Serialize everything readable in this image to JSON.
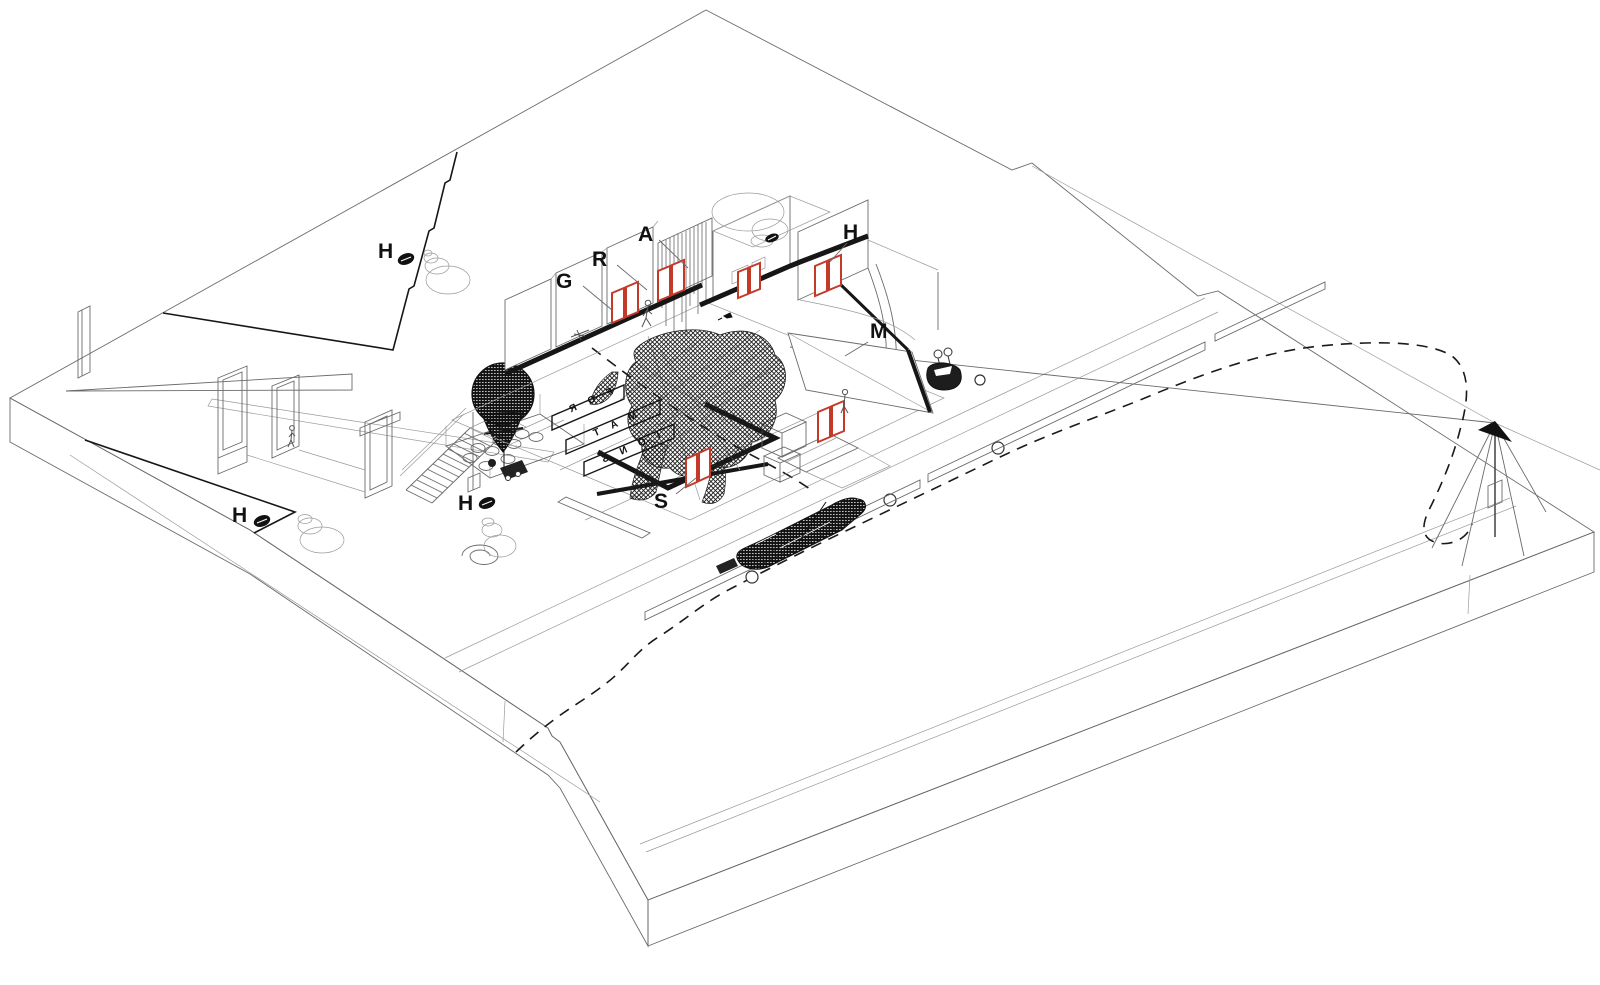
{
  "drawing": {
    "type": "axonometric-site-plan",
    "labels": [
      {
        "id": "G",
        "text": "G"
      },
      {
        "id": "R",
        "text": "R"
      },
      {
        "id": "A",
        "text": "A"
      },
      {
        "id": "H-wall",
        "text": "H"
      },
      {
        "id": "M",
        "text": "M"
      },
      {
        "id": "S",
        "text": "S"
      },
      {
        "id": "H-field",
        "text": "H"
      },
      {
        "id": "H-shore",
        "text": "H"
      },
      {
        "id": "H-deck",
        "text": "H"
      }
    ],
    "sign": {
      "word": "FORMATIONS",
      "rows": [
        "F O R",
        "M A T",
        "I O N S"
      ]
    },
    "colors": {
      "accent_red": "#c43a28",
      "ink": "#1a1a1a",
      "line": "#555555",
      "faint": "#999999",
      "background": "#ffffff"
    }
  }
}
